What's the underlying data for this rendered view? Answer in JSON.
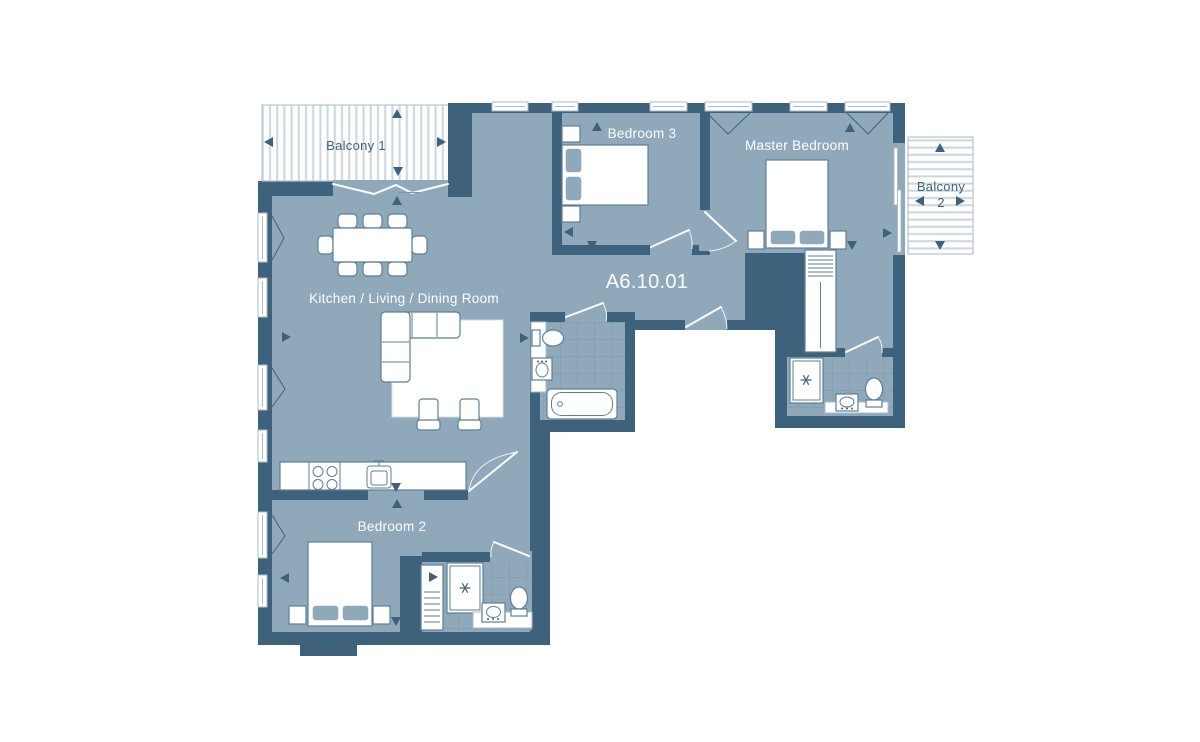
{
  "plan": {
    "unit_number": "A6.10.01",
    "rooms": {
      "kitchen_living_dining": "Kitchen / Living / Dining Room",
      "bedroom2": "Bedroom 2",
      "bedroom3": "Bedroom 3",
      "master_bedroom": "Master Bedroom",
      "balcony1": "Balcony 1",
      "balcony2_line1": "Balcony",
      "balcony2_line2": "2"
    },
    "colors": {
      "wall": "#3E627B",
      "floor": "#8FA9BA",
      "tile": "#7C98AC",
      "stripe": "#CBD7DE",
      "furn": "#5E7F95",
      "win": "#A9BCC9",
      "balc": "#B3C4CF",
      "rug": "#D5DFE6",
      "label_light": "#FFFFFF",
      "label_dark": "#3E627B"
    }
  }
}
